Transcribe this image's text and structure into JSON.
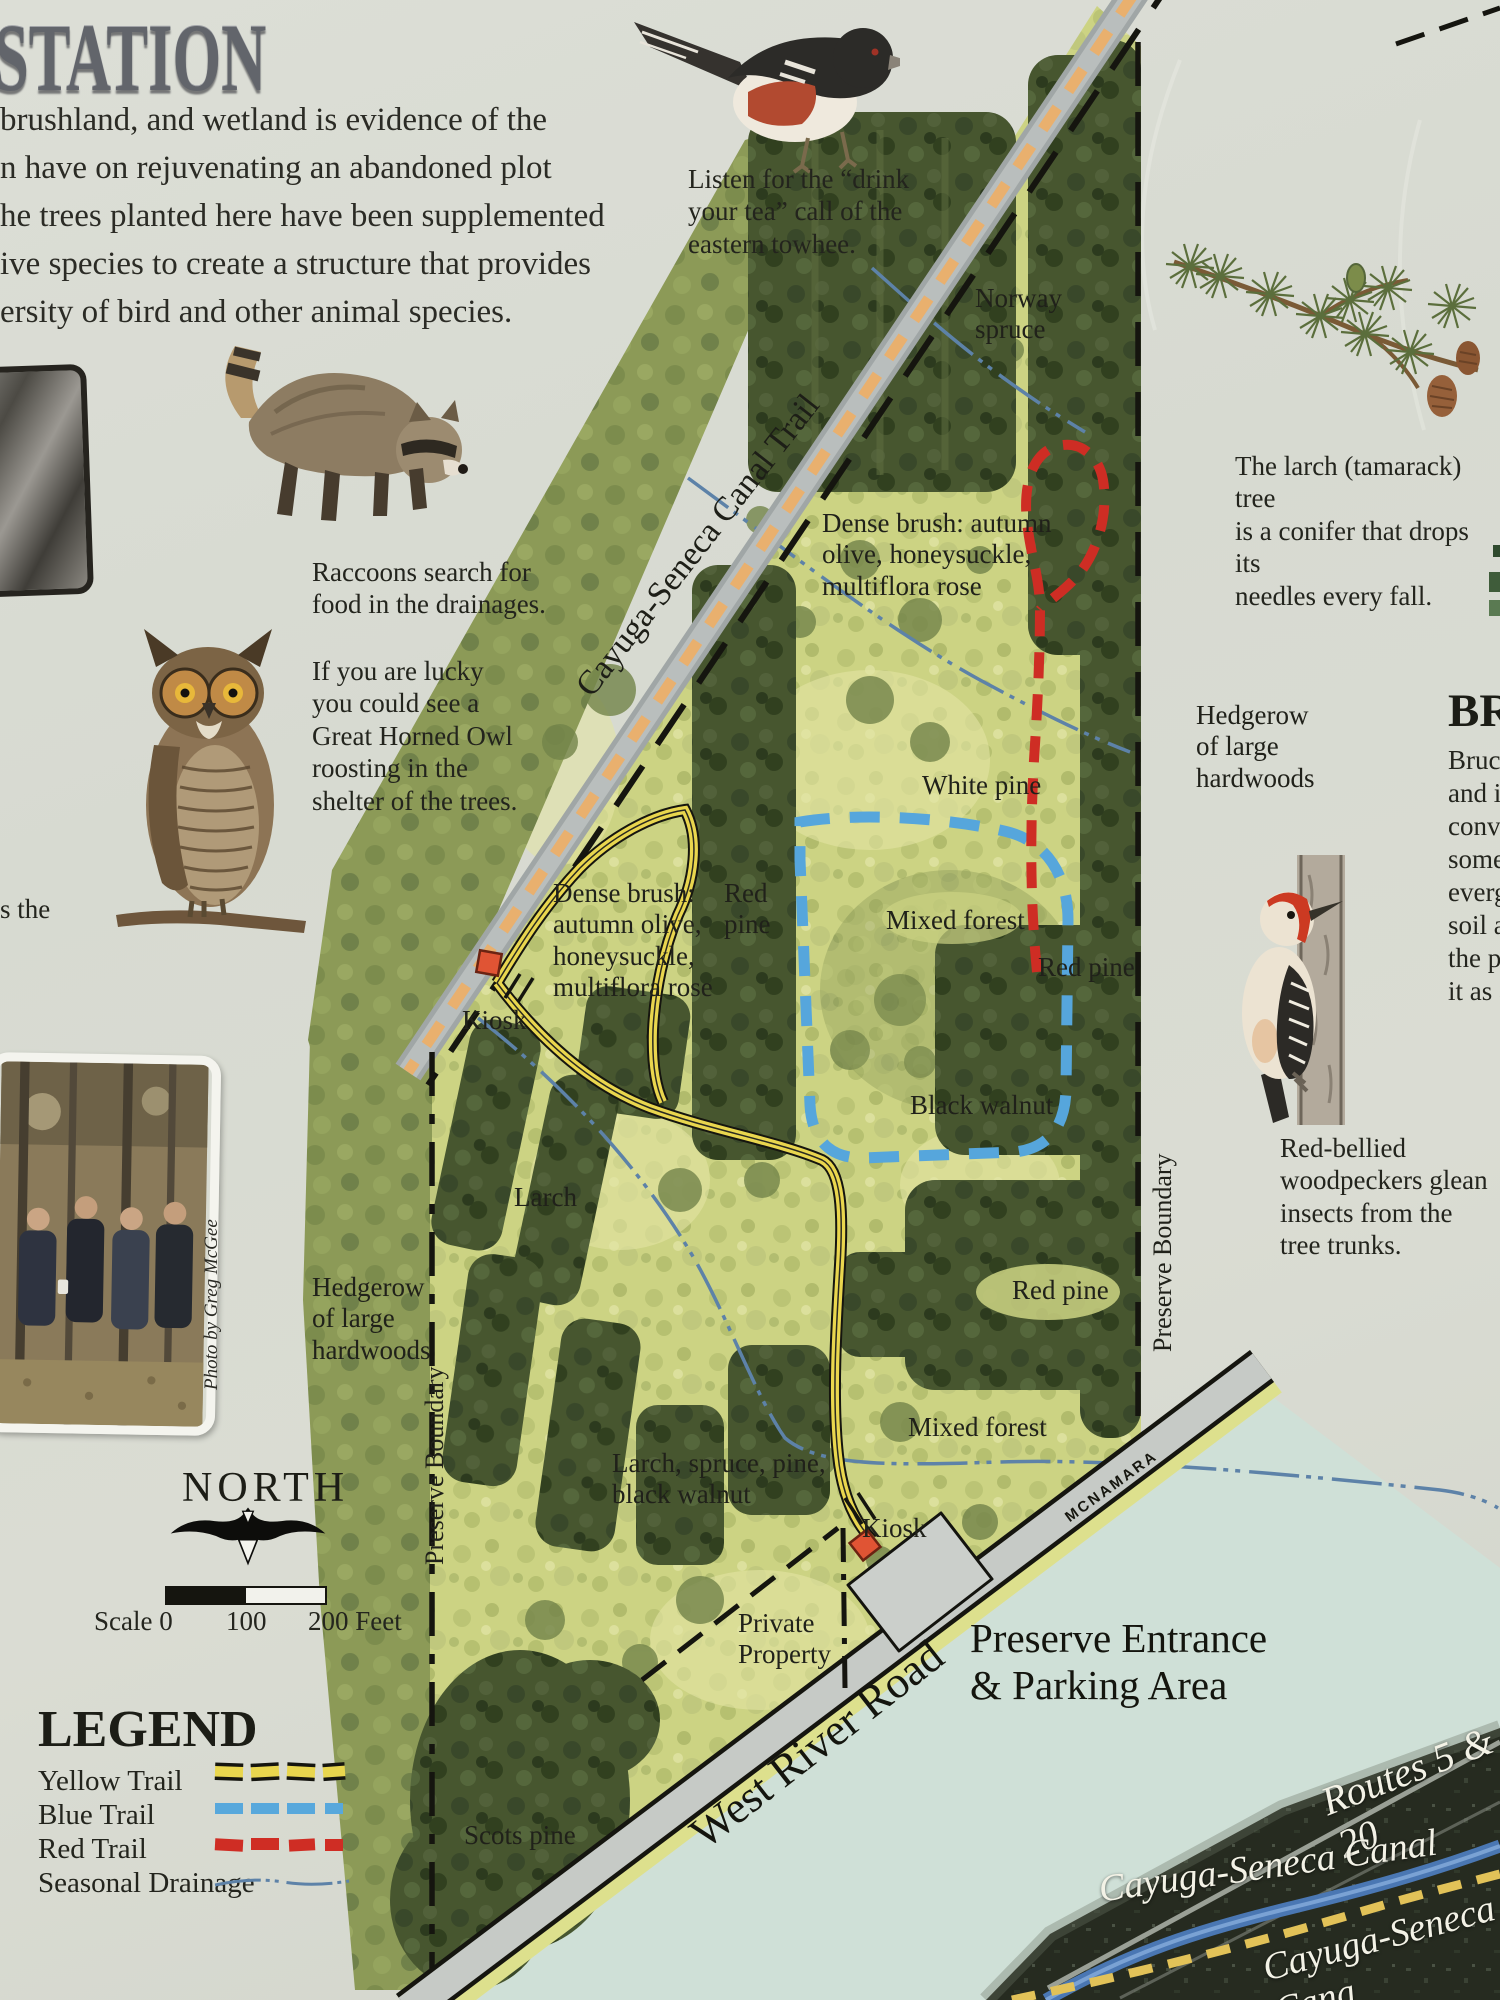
{
  "title": {
    "fragment": "STATION"
  },
  "intro": {
    "lines": "brushland, and wetland is evidence of the\nn have on rejuvenating an abandoned plot\nhe trees planted here have been supplemented\nive species to create a structure that provides\nersity of bird and other animal species."
  },
  "edge_fragment": "s the",
  "captions": {
    "towhee": "Listen for the “drink\nyour tea” call of the\neastern towhee.",
    "larch": "The larch (tamarack) tree\nis a conifer that drops its\nneedles every fall.",
    "raccoon": "Raccoons search for\nfood in the drainages.",
    "owl": "If you are lucky\nyou could see a\nGreat Horned Owl\nroosting in the\nshelter of the trees.",
    "woodpecker": "Red-bellied\nwoodpeckers glean\ninsects from the\ntree trunks.",
    "photo_credit": "Photo by Greg McGee"
  },
  "article_right": {
    "heading_fragment": "BR",
    "body_fragments": "Bruce\nand in\nconve\nsome\nevergr\nsoil ar\nthe pr\nit as a"
  },
  "compass": {
    "label": "NORTH"
  },
  "scalebar": {
    "left": "Scale 0",
    "mid": "100",
    "right": "200 Feet"
  },
  "legend": {
    "title": "LEGEND",
    "items": [
      {
        "label": "Yellow Trail",
        "color": "#e9d64e"
      },
      {
        "label": "Blue Trail",
        "color": "#58a8dc"
      },
      {
        "label": "Red Trail",
        "color": "#cf2d24"
      },
      {
        "label": "Seasonal Drainage",
        "color": "#5d82a8"
      }
    ]
  },
  "palette": {
    "paper": "#d9dbd3",
    "map_green": "#ccd383",
    "dark_trees": "#47562f",
    "trail_gray": "#a0a6a6",
    "trail_orange_dash": "#e9b06e",
    "road_gray": "#c6cac6",
    "water_teal": "#cfe0d7",
    "aerial_dark": "#262b20",
    "canal_blue": "#4a77b3",
    "white_label": "#f3f2e6"
  },
  "map": {
    "labels": [
      {
        "id": "norway-spruce",
        "text": "Norway\nspruce"
      },
      {
        "id": "dense-brush-upper",
        "text": "Dense brush: autumn\nolive, honeysuckle,\nmultiflora rose"
      },
      {
        "id": "white-pine",
        "text": "White pine"
      },
      {
        "id": "hedgerow-right",
        "text": "Hedgerow\nof large\nhardwoods"
      },
      {
        "id": "dense-brush-lower",
        "text": "Dense brush:\nautumn olive,\nhoneysuckle,\nmultiflora rose"
      },
      {
        "id": "red-pine-center",
        "text": "Red\npine"
      },
      {
        "id": "mixed-forest-upper",
        "text": "Mixed forest"
      },
      {
        "id": "red-pine-right",
        "text": "Red pine"
      },
      {
        "id": "kiosk-upper",
        "text": "Kiosk"
      },
      {
        "id": "black-walnut",
        "text": "Black walnut"
      },
      {
        "id": "larch",
        "text": "Larch"
      },
      {
        "id": "preserve-boundary-right",
        "text": "Preserve Boundary"
      },
      {
        "id": "red-pine-lower",
        "text": "Red pine"
      },
      {
        "id": "hedgerow-left",
        "text": "Hedgerow\nof large\nhardwoods"
      },
      {
        "id": "preserve-boundary-left",
        "text": "Preserve Boundary"
      },
      {
        "id": "mixed-forest-lower",
        "text": "Mixed forest"
      },
      {
        "id": "larch-spruce-pine",
        "text": "Larch, spruce, pine,\nblack walnut"
      },
      {
        "id": "kiosk-lower",
        "text": "Kiosk"
      },
      {
        "id": "mcnamara",
        "text": "MCNAMARA"
      },
      {
        "id": "private-property",
        "text": "Private\nProperty"
      },
      {
        "id": "preserve-entrance",
        "text": "Preserve Entrance\n& Parking Area"
      },
      {
        "id": "west-river-road",
        "text": "West River Road"
      },
      {
        "id": "scots-pine",
        "text": "Scots pine"
      },
      {
        "id": "routes-5-20",
        "text": "Routes 5 & 20"
      },
      {
        "id": "cayuga-seneca-canal",
        "text": "Cayuga-Seneca Canal"
      },
      {
        "id": "cayuga-seneca-canal-2",
        "text": "Cayuga-Seneca Cana"
      },
      {
        "id": "canal-trail",
        "text": "Cayuga-Seneca Canal Trail"
      }
    ]
  }
}
